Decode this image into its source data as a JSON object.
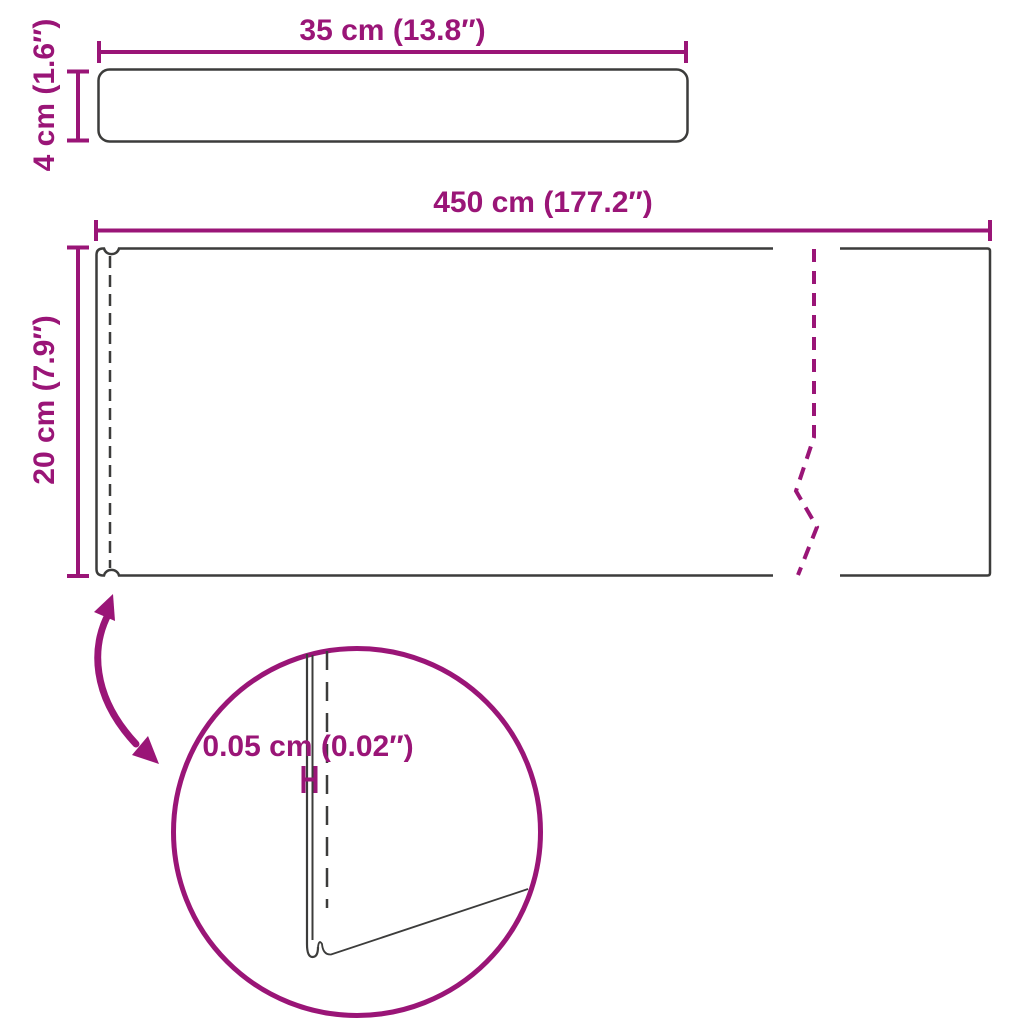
{
  "diagram_title": "product-dimension-diagram",
  "labels": {
    "bar_width": "35 cm (13.8″)",
    "bar_height": "4 cm (1.6″)",
    "mat_width": "450 cm (177.2″)",
    "mat_height": "20 cm (7.9″)",
    "thickness": "0.05 cm (0.02″)"
  },
  "colors": {
    "accent": "#9A1577",
    "outline": "#3C3C3B",
    "background": "#FFFFFF"
  },
  "chart_data": {
    "type": "table",
    "title": "Product dimensions",
    "measurements": [
      {
        "part": "top-bar",
        "dimension": "width",
        "value_cm": 35,
        "value_in": 13.8
      },
      {
        "part": "top-bar",
        "dimension": "height",
        "value_cm": 4,
        "value_in": 1.6
      },
      {
        "part": "mat",
        "dimension": "length",
        "value_cm": 450,
        "value_in": 177.2
      },
      {
        "part": "mat",
        "dimension": "width",
        "value_cm": 20,
        "value_in": 7.9
      },
      {
        "part": "mat",
        "dimension": "thickness",
        "value_cm": 0.05,
        "value_in": 0.02
      }
    ]
  }
}
